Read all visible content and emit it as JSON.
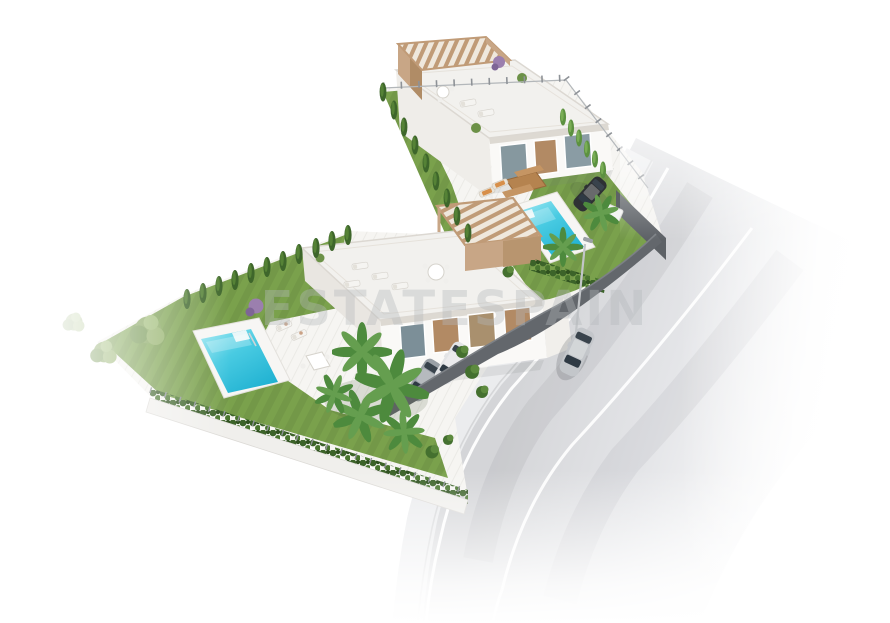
{
  "scene": {
    "watermark_text": "ESTATESPAIN",
    "labels": {
      "canvas": "Aerial 3D render of a residential plot with two modern villas, pools, gardens and street",
      "villa_upper": "Upper white villa with rooftop pergola terrace and sun loungers",
      "villa_lower": "Lower white villa with rooftop pergola terrace and sun loungers",
      "pool_upper": "Turquoise swimming pool beside upper villa",
      "pool_lower": "Turquoise swimming pool in lower garden",
      "lawn": "Landscaped lawn with trees and hedges",
      "road": "Asphalt street with white lane markings",
      "sidewalk": "Sidewalk along plot boundary",
      "car_road": "Silver car driving on the street",
      "car_suv": "Dark SUV parked by upper pool",
      "cars_driveway": "Two cars parked in villa driveway",
      "boundary_wall": "Dark grey boundary wall and fences",
      "street_lamp": "Street lamp",
      "watermark": "Translucent agency watermark"
    },
    "palette": {
      "pool_water": "#2fbcd8",
      "pool_water_light": "#9fe8f2",
      "lawn_green": "#7aa14c",
      "hedge_green": "#3c6329",
      "cypress_bright": "#5c9140",
      "pergola_wood": "#c8a686",
      "building_white": "#faf9f7",
      "roof_deck": "#f2f1ee",
      "wall_dark": "#63676c",
      "road_grey": "#d6d7d9",
      "sidewalk_grey": "#ebecee",
      "car_silver": "#c3c6ca",
      "car_dark": "#2e3134",
      "watermark_grey": "#b5b9bc"
    }
  }
}
